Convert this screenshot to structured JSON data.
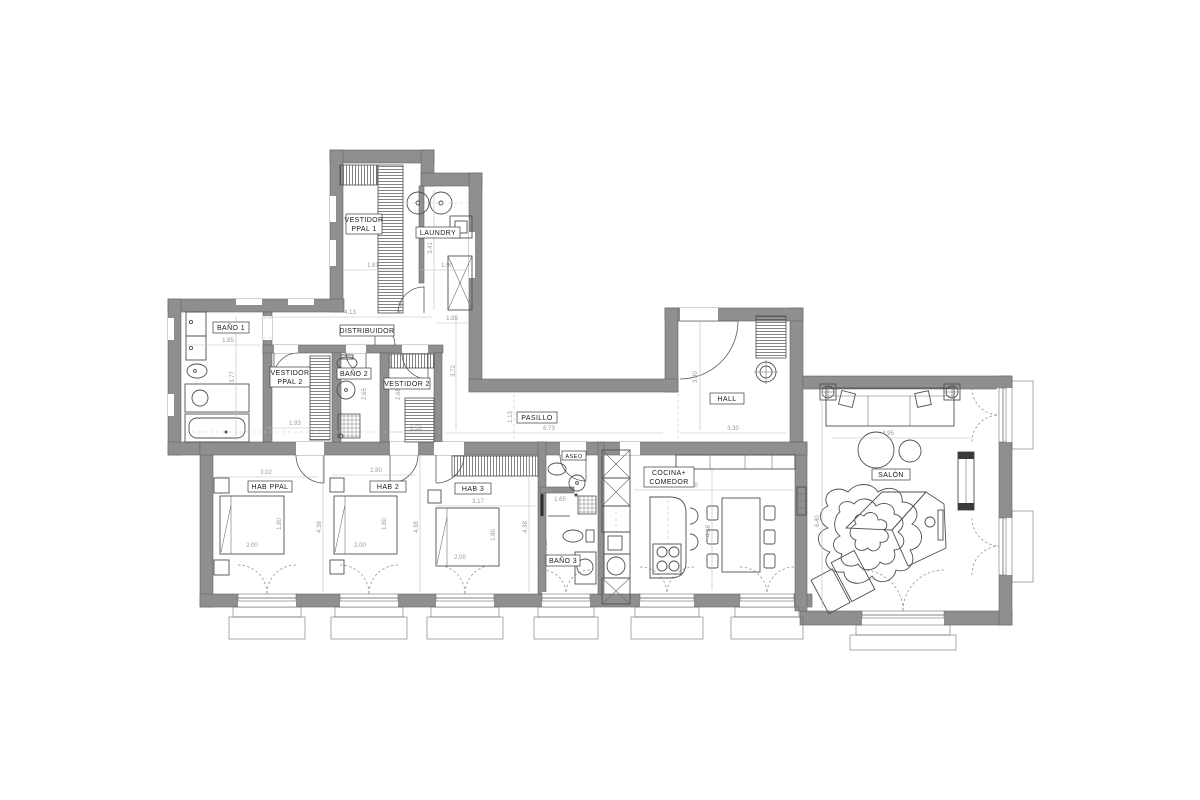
{
  "plan": {
    "background": "#ffffff",
    "wall_color": "#8f8f8f",
    "wall_outline": "#636363",
    "furniture_line_color": "#4f4f4f",
    "dim_color": "#9a9a9a",
    "label_color": "#1a1a1a",
    "labels": {
      "vestidor_ppal_1_1": "VESTIDOR",
      "vestidor_ppal_1_2": "PPAL 1",
      "laundry": "LAUNDRY",
      "distribuidor": "DISTRIBUIDOR",
      "bano_1": "BAÑO 1",
      "vestidor_ppal_2_1": "VESTIDOR",
      "vestidor_ppal_2_2": "PPAL 2",
      "bano_2": "BAÑO 2",
      "vestidor_2": "VESTIDOR 2",
      "pasillo": "PASILLO",
      "hall": "HALL",
      "hab_ppal": "HAB PPAL",
      "hab_2": "HAB 2",
      "hab_3": "HAB 3",
      "aseo": "ASEO",
      "bano_3": "BAÑO 3",
      "cocina_1": "COCINA+",
      "cocina_2": "COMEDOR",
      "salon": "SALÓN"
    },
    "dims": [
      "1.81",
      "1.90",
      "3.41",
      "1.85",
      "4.13",
      "1.88",
      "1.85",
      "3.77",
      "1.93",
      "2.65",
      "2.68",
      "1.58",
      "3.72",
      "6.73",
      "1.13",
      "3.40",
      "3.30",
      "3.02",
      "4.38",
      "1.80",
      "2.00",
      "2.80",
      "4.38",
      "1.80",
      "2.00",
      "3.17",
      "4.38",
      "1.80",
      "2.00",
      "1.65",
      "3.28",
      "5.50",
      "4.38",
      "4.95",
      "6.40"
    ]
  }
}
